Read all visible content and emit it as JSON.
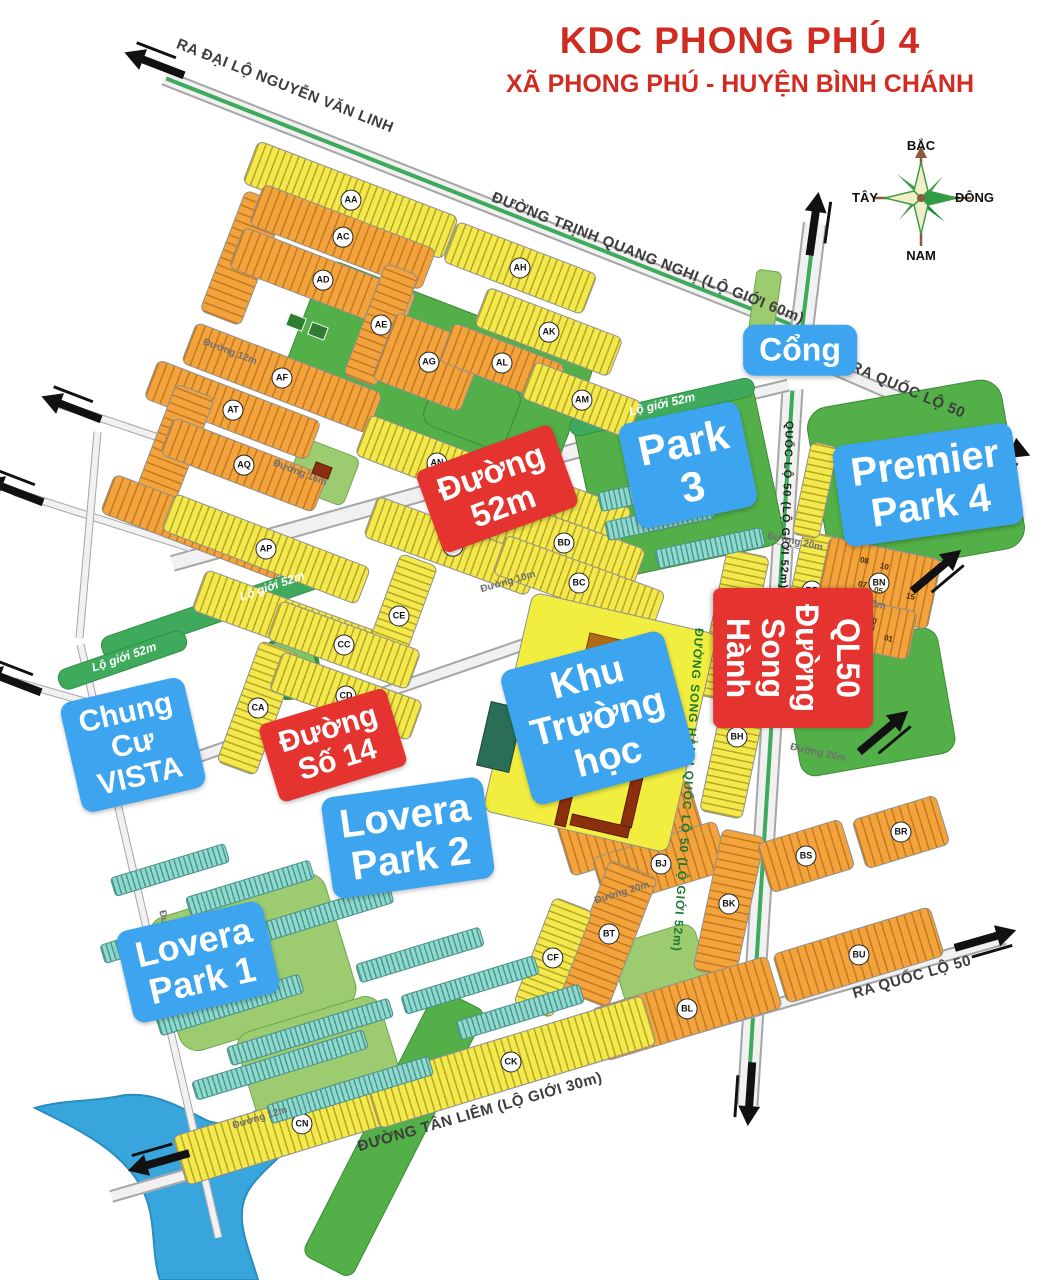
{
  "title": {
    "line1": "KDC PHONG PHÚ 4",
    "line2": "XÃ PHONG PHÚ - HUYỆN BÌNH CHÁNH"
  },
  "compass": {
    "north": "BẮC",
    "south": "NAM",
    "west": "TÂY",
    "east": "ĐÔNG"
  },
  "colors": {
    "title_red": "#d02c22",
    "overlay_blue": "#3da4f0",
    "overlay_red": "#e53430",
    "block_orange": "#f2a33c",
    "block_yellow": "#f3e84c",
    "teal": "#8fd9ce",
    "park_green": "#53af47",
    "river_blue": "#39a5dd",
    "median_green": "#3faa5c"
  },
  "overlay_labels": [
    {
      "name": "label-cong",
      "color": "blue",
      "lines": [
        "Cổng"
      ],
      "x": 800,
      "y": 350,
      "r": 0,
      "size": 32
    },
    {
      "name": "label-park-3",
      "color": "blue",
      "lines": [
        "Park 3"
      ],
      "x": 688,
      "y": 465,
      "r": -12,
      "size": 42
    },
    {
      "name": "label-premier-park-4",
      "color": "blue",
      "lines": [
        "Premier",
        "Park 4"
      ],
      "x": 928,
      "y": 485,
      "r": -8,
      "size": 40
    },
    {
      "name": "label-chung-cu-vista",
      "color": "blue",
      "lines": [
        "Chung Cư",
        "VISTA"
      ],
      "x": 133,
      "y": 745,
      "r": -13,
      "size": 30
    },
    {
      "name": "label-khu-truong-hoc",
      "color": "blue",
      "lines": [
        "Khu",
        "Trường học"
      ],
      "x": 598,
      "y": 718,
      "r": -15,
      "size": 38
    },
    {
      "name": "label-lovera-park-2",
      "color": "blue",
      "lines": [
        "Lovera",
        "Park 2"
      ],
      "x": 408,
      "y": 838,
      "r": -8,
      "size": 40
    },
    {
      "name": "label-lovera-park-1",
      "color": "blue",
      "lines": [
        "Lovera Park 1"
      ],
      "x": 198,
      "y": 962,
      "r": -13,
      "size": 36
    },
    {
      "name": "label-duong-52m",
      "color": "red",
      "lines": [
        "Đường 52m"
      ],
      "x": 497,
      "y": 489,
      "r": -20,
      "size": 33
    },
    {
      "name": "label-duong-so-14",
      "color": "red",
      "lines": [
        "Đường Số 14"
      ],
      "x": 333,
      "y": 745,
      "r": -17,
      "size": 30
    },
    {
      "name": "label-duong-song-hanh-ql50",
      "color": "red",
      "vertical": true,
      "lines": [
        "Đường Song Hành",
        "QL50"
      ],
      "x": 793,
      "y": 658,
      "r": 90,
      "size": 32
    }
  ],
  "road_names": [
    {
      "cls": "big",
      "text": "RA ĐẠI LỘ NGUYỄN VĂN LINH",
      "x": 285,
      "y": 86,
      "r": 21.5
    },
    {
      "cls": "big",
      "text": "ĐƯỜNG TRỊNH QUANG NGHỊ (LỘ GIỚI 60m)",
      "x": 648,
      "y": 258,
      "r": 21.5
    },
    {
      "cls": "big",
      "text": "RA QUỐC LỘ 50",
      "x": 908,
      "y": 390,
      "r": 23
    },
    {
      "cls": "big",
      "text": "RA QUỐC LỘ 50",
      "x": 912,
      "y": 977,
      "r": -16
    },
    {
      "cls": "big",
      "text": "ĐƯỜNG TÂN LIÊM (LỘ GIỚI 30m)",
      "x": 480,
      "y": 1112,
      "r": -16
    },
    {
      "cls": "blk",
      "text": "QUỐC LỘ 50 (LỘ GIỚI 52m)",
      "x": 786,
      "y": 505,
      "r": 92
    },
    {
      "cls": "grn",
      "text": "ĐƯỜNG SONG HÀNH QUỐC LỘ 50 (LỘ GIỚI 52m)",
      "x": 688,
      "y": 790,
      "r": 94
    },
    {
      "cls": "med",
      "text": "Lộ giới 52m",
      "x": 272,
      "y": 586,
      "r": -19
    },
    {
      "cls": "med",
      "text": "Lộ giới 52m",
      "x": 124,
      "y": 657,
      "r": -19
    },
    {
      "cls": "med",
      "text": "Lộ giới 52m",
      "x": 662,
      "y": 404,
      "r": -13
    },
    {
      "cls": "min",
      "text": "Đường 20m",
      "x": 795,
      "y": 542,
      "r": 12.5
    },
    {
      "cls": "min",
      "text": "Đường 13m",
      "x": 858,
      "y": 601,
      "r": 12
    },
    {
      "cls": "min",
      "text": "Đường 12m",
      "x": 846,
      "y": 663,
      "r": 12
    },
    {
      "cls": "min",
      "text": "Đường 20m",
      "x": 818,
      "y": 753,
      "r": 12
    },
    {
      "cls": "min",
      "text": "Đường 16m",
      "x": 300,
      "y": 473,
      "r": 21
    },
    {
      "cls": "min",
      "text": "Đường 12m",
      "x": 230,
      "y": 352,
      "r": 21
    },
    {
      "cls": "min",
      "text": "Đường 10m",
      "x": 508,
      "y": 582,
      "r": -16
    },
    {
      "cls": "min",
      "text": "Đường 20m",
      "x": 622,
      "y": 893,
      "r": -17
    },
    {
      "cls": "min",
      "text": "Đường 12m",
      "x": 260,
      "y": 1118,
      "r": -17
    },
    {
      "cls": "min",
      "text": "Đường 16m",
      "x": 168,
      "y": 938,
      "r": 77
    }
  ],
  "roads": [
    {
      "x": 490,
      "y": 206,
      "len": 700,
      "w": 16,
      "r": 21.5,
      "median": true
    },
    {
      "x": 807,
      "y": 288,
      "len": 130,
      "w": 24,
      "r": -83,
      "median": true
    },
    {
      "x": 918,
      "y": 405,
      "len": 196,
      "w": 13,
      "r": 23.4,
      "median": false
    },
    {
      "x": 770,
      "y": 747,
      "len": 718,
      "w": 22,
      "r": 93.6,
      "median": true
    },
    {
      "x": 558,
      "y": 1067,
      "len": 930,
      "w": 13,
      "r": -16.1,
      "median": false
    },
    {
      "x": 415,
      "y": 495,
      "len": 505,
      "w": 17,
      "r": -15.6,
      "median": false
    },
    {
      "x": 376,
      "y": 695,
      "len": 584,
      "w": 13,
      "r": -19,
      "median": false
    },
    {
      "x": 691,
      "y": 408,
      "len": 200,
      "w": 13,
      "r": -13.5,
      "median": false
    },
    {
      "x": 807,
      "y": 546,
      "len": 205,
      "w": 9,
      "r": 12.5,
      "median": false
    },
    {
      "x": 145,
      "y": 433,
      "len": 180,
      "w": 8,
      "r": 18.5,
      "median": false
    },
    {
      "x": 102,
      "y": 520,
      "len": 185,
      "w": 8,
      "r": 17.7,
      "median": false
    },
    {
      "x": 55,
      "y": 693,
      "len": 84,
      "w": 8,
      "r": 16,
      "median": false
    },
    {
      "x": 88,
      "y": 535,
      "len": 207,
      "w": 8,
      "r": 95,
      "median": false
    },
    {
      "x": 149,
      "y": 941,
      "len": 609,
      "w": 8,
      "r": 76.9,
      "median": false
    }
  ],
  "blocks": [
    {
      "id": "AA",
      "t": "y",
      "x": 350,
      "y": 200,
      "w": 215,
      "h": 46,
      "r": 21
    },
    {
      "id": "AB",
      "t": "o",
      "x": 243,
      "y": 258,
      "w": 44,
      "h": 130,
      "r": 21
    },
    {
      "id": "AC",
      "t": "o",
      "x": 342,
      "y": 237,
      "w": 185,
      "h": 44,
      "r": 21
    },
    {
      "id": "AD",
      "t": "o",
      "x": 322,
      "y": 280,
      "w": 185,
      "h": 44,
      "r": 21
    },
    {
      "id": "AE",
      "t": "o",
      "x": 381,
      "y": 325,
      "w": 36,
      "h": 120,
      "r": 21
    },
    {
      "id": "AF",
      "t": "o",
      "x": 282,
      "y": 378,
      "w": 200,
      "h": 44,
      "r": 21
    },
    {
      "id": "AG",
      "t": "o",
      "x": 428,
      "y": 362,
      "w": 95,
      "h": 72,
      "r": 21
    },
    {
      "id": "AH",
      "t": "y",
      "x": 520,
      "y": 268,
      "w": 150,
      "h": 44,
      "r": 21
    },
    {
      "id": "AK",
      "t": "y",
      "x": 548,
      "y": 332,
      "w": 145,
      "h": 42,
      "r": 21
    },
    {
      "id": "AL",
      "t": "o",
      "x": 502,
      "y": 363,
      "w": 120,
      "h": 42,
      "r": 21
    },
    {
      "id": "AM",
      "t": "y",
      "x": 581,
      "y": 400,
      "w": 115,
      "h": 40,
      "r": 21
    },
    {
      "id": "AT",
      "t": "o",
      "x": 232,
      "y": 410,
      "w": 175,
      "h": 42,
      "r": 21
    },
    {
      "id": "AS",
      "t": "o",
      "x": 176,
      "y": 442,
      "w": 42,
      "h": 110,
      "r": 21
    },
    {
      "id": "AQ",
      "t": "o",
      "x": 243,
      "y": 465,
      "w": 165,
      "h": 40,
      "r": 21
    },
    {
      "id": "AR",
      "t": "o",
      "x": 196,
      "y": 527,
      "w": 190,
      "h": 42,
      "r": 21
    },
    {
      "id": "AP",
      "t": "y",
      "x": 266,
      "y": 549,
      "w": 210,
      "h": 40,
      "r": 21
    },
    {
      "id": "AN",
      "t": "y",
      "x": 437,
      "y": 463,
      "w": 160,
      "h": 44,
      "r": 21
    },
    {
      "id": "BE",
      "t": "y",
      "x": 545,
      "y": 500,
      "w": 170,
      "h": 44,
      "r": 20
    },
    {
      "id": "BA",
      "t": "y",
      "x": 452,
      "y": 546,
      "w": 175,
      "h": 44,
      "r": 20
    },
    {
      "id": "BD",
      "t": "y",
      "x": 564,
      "y": 543,
      "w": 160,
      "h": 44,
      "r": 20
    },
    {
      "id": "BC",
      "t": "y",
      "x": 579,
      "y": 583,
      "w": 170,
      "h": 42,
      "r": 20
    },
    {
      "id": "CB",
      "t": "y",
      "x": 288,
      "y": 622,
      "w": 190,
      "h": 44,
      "r": 20
    },
    {
      "id": "CE",
      "t": "y",
      "x": 399,
      "y": 616,
      "w": 40,
      "h": 120,
      "r": 20
    },
    {
      "id": "CC",
      "t": "y",
      "x": 344,
      "y": 645,
      "w": 150,
      "h": 42,
      "r": 20
    },
    {
      "id": "CA",
      "t": "y",
      "x": 258,
      "y": 708,
      "w": 42,
      "h": 130,
      "r": 20
    },
    {
      "id": "CD",
      "t": "y",
      "x": 346,
      "y": 696,
      "w": 150,
      "h": 42,
      "r": 20
    },
    {
      "id": "BG",
      "t": "y",
      "x": 733,
      "y": 626,
      "w": 44,
      "h": 150,
      "r": 12
    },
    {
      "id": "BH",
      "t": "y",
      "x": 737,
      "y": 737,
      "w": 44,
      "h": 160,
      "r": 12
    },
    {
      "id": "BP",
      "t": "y",
      "x": 812,
      "y": 590,
      "w": 42,
      "h": 115,
      "r": 12
    },
    {
      "id": "BN",
      "t": "o",
      "x": 878,
      "y": 583,
      "w": 115,
      "h": 72,
      "r": 12
    },
    {
      "id": "BM",
      "t": "o",
      "x": 864,
      "y": 626,
      "w": 100,
      "h": 50,
      "r": 12
    },
    {
      "id": "BF",
      "t": "o",
      "x": 630,
      "y": 828,
      "w": 140,
      "h": 60,
      "r": -17
    },
    {
      "id": "BJ",
      "t": "o",
      "x": 661,
      "y": 864,
      "w": 130,
      "h": 52,
      "r": -17
    },
    {
      "id": "BK",
      "t": "o",
      "x": 729,
      "y": 903,
      "w": 44,
      "h": 145,
      "r": 12
    },
    {
      "id": "BT",
      "t": "o",
      "x": 609,
      "y": 934,
      "w": 52,
      "h": 140,
      "r": 21
    },
    {
      "id": "BL",
      "t": "o",
      "x": 686,
      "y": 1008,
      "w": 185,
      "h": 55,
      "r": -17
    },
    {
      "id": "BU",
      "t": "o",
      "x": 858,
      "y": 955,
      "w": 165,
      "h": 52,
      "r": -17
    },
    {
      "id": "BS",
      "t": "o",
      "x": 806,
      "y": 856,
      "w": 88,
      "h": 52,
      "r": -17
    },
    {
      "id": "BR",
      "t": "o",
      "x": 901,
      "y": 832,
      "w": 88,
      "h": 52,
      "r": -17
    },
    {
      "id": "CF",
      "t": "y",
      "x": 553,
      "y": 957,
      "w": 42,
      "h": 115,
      "r": 21
    },
    {
      "id": "CN",
      "t": "y",
      "x": 301,
      "y": 1124,
      "w": 255,
      "h": 52,
      "r": -17
    },
    {
      "id": "CK",
      "t": "y",
      "x": 511,
      "y": 1062,
      "w": 290,
      "h": 52,
      "r": -17
    },
    {
      "id": "",
      "t": "y",
      "x": 815,
      "y": 490,
      "w": 28,
      "h": 95,
      "r": 12
    },
    {
      "id": "",
      "t": "school",
      "x": 600,
      "y": 722,
      "w": 190,
      "h": 225,
      "r": 13
    }
  ],
  "teal_rows": [
    [
      170,
      870,
      120,
      -17
    ],
    [
      250,
      888,
      130,
      -17
    ],
    [
      150,
      940,
      100,
      -17
    ],
    [
      320,
      915,
      150,
      -17
    ],
    [
      230,
      1005,
      150,
      -17
    ],
    [
      310,
      1032,
      170,
      -17
    ],
    [
      280,
      1065,
      180,
      -17
    ],
    [
      350,
      1090,
      170,
      -17
    ],
    [
      420,
      955,
      130,
      -17
    ],
    [
      470,
      985,
      140,
      -17
    ],
    [
      520,
      1012,
      130,
      -17
    ],
    [
      660,
      520,
      110,
      -12
    ],
    [
      710,
      548,
      110,
      -12
    ],
    [
      648,
      492,
      100,
      -12
    ]
  ],
  "parks": [
    {
      "t": "green",
      "x": 435,
      "y": 378,
      "w": 290,
      "h": 148,
      "r": 21,
      "rad": 16
    },
    {
      "t": "court",
      "x": 296,
      "y": 322,
      "w": 18,
      "h": 14,
      "r": 21
    },
    {
      "t": "court",
      "x": 318,
      "y": 331,
      "w": 18,
      "h": 14,
      "r": 21
    },
    {
      "t": "light",
      "x": 323,
      "y": 472,
      "w": 62,
      "h": 52,
      "r": 21,
      "rad": 8
    },
    {
      "t": "green",
      "x": 472,
      "y": 407,
      "w": 88,
      "h": 66,
      "r": 21,
      "rad": 14
    },
    {
      "t": "ring",
      "x": 288,
      "y": 668,
      "w": 64,
      "h": 64,
      "r": 0
    },
    {
      "t": "green",
      "x": 678,
      "y": 480,
      "w": 185,
      "h": 168,
      "r": -12,
      "rad": 18
    },
    {
      "t": "green",
      "x": 916,
      "y": 478,
      "w": 198,
      "h": 172,
      "r": -10,
      "rad": 22
    },
    {
      "t": "light",
      "x": 765,
      "y": 303,
      "w": 26,
      "h": 66,
      "r": 8,
      "rad": 6
    },
    {
      "t": "green",
      "x": 869,
      "y": 702,
      "w": 158,
      "h": 128,
      "r": -10,
      "rad": 16
    },
    {
      "t": "light",
      "x": 666,
      "y": 985,
      "w": 88,
      "h": 108,
      "r": -17,
      "rad": 14
    },
    {
      "t": "light",
      "x": 252,
      "y": 962,
      "w": 185,
      "h": 140,
      "r": -17,
      "rad": 20
    },
    {
      "t": "light",
      "x": 318,
      "y": 1058,
      "w": 150,
      "h": 92,
      "r": -17,
      "rad": 16
    },
    {
      "t": "green",
      "x": 394,
      "y": 1133,
      "w": 56,
      "h": 300,
      "r": 27,
      "rad": 10
    },
    {
      "t": "median",
      "x": 225,
      "y": 608,
      "w": 260,
      "h": 24,
      "r": -19
    },
    {
      "t": "median",
      "x": 122,
      "y": 660,
      "w": 135,
      "h": 22,
      "r": -19
    },
    {
      "t": "median",
      "x": 662,
      "y": 407,
      "w": 190,
      "h": 20,
      "r": -13
    },
    {
      "t": "light",
      "x": 563,
      "y": 662,
      "w": 40,
      "h": 36,
      "r": 13,
      "rad": 6
    },
    {
      "t": "light",
      "x": 650,
      "y": 700,
      "w": 44,
      "h": 40,
      "r": 13,
      "rad": 6
    },
    {
      "t": "light",
      "x": 572,
      "y": 800,
      "w": 40,
      "h": 44,
      "r": 13,
      "rad": 6
    }
  ],
  "buildings": [
    {
      "x": 612,
      "y": 655,
      "w": 54,
      "h": 34,
      "r": 13,
      "c": "#b06a12"
    },
    {
      "x": 600,
      "y": 768,
      "w": 86,
      "h": 12,
      "r": 13,
      "c": "#8b2f0e"
    },
    {
      "x": 567,
      "y": 795,
      "w": 12,
      "h": 64,
      "r": 13,
      "c": "#8b2f0e"
    },
    {
      "x": 633,
      "y": 796,
      "w": 12,
      "h": 64,
      "r": 13,
      "c": "#8b2f0e"
    },
    {
      "x": 600,
      "y": 826,
      "w": 60,
      "h": 12,
      "r": 13,
      "c": "#8b2f0e"
    },
    {
      "x": 322,
      "y": 470,
      "w": 18,
      "h": 13,
      "r": 21,
      "c": "#8b2f0e"
    },
    {
      "x": 500,
      "y": 737,
      "w": 34,
      "h": 66,
      "r": 13,
      "c": "#2b6e57"
    }
  ],
  "lot_numbers": [
    {
      "t": "08",
      "x": 860,
      "y": 556
    },
    {
      "t": "10",
      "x": 880,
      "y": 562
    },
    {
      "t": "07",
      "x": 858,
      "y": 580
    },
    {
      "t": "05",
      "x": 874,
      "y": 586
    },
    {
      "t": "15",
      "x": 906,
      "y": 592
    },
    {
      "t": "05",
      "x": 846,
      "y": 620
    },
    {
      "t": "10",
      "x": 868,
      "y": 616
    },
    {
      "t": "03",
      "x": 856,
      "y": 640
    },
    {
      "t": "01",
      "x": 884,
      "y": 634
    }
  ],
  "arrows": [
    {
      "x": 155,
      "y": 62,
      "r": -69
    },
    {
      "x": 816,
      "y": 224,
      "r": 8
    },
    {
      "x": 1000,
      "y": 445,
      "r": 113
    },
    {
      "x": 938,
      "y": 572,
      "r": 50
    },
    {
      "x": 885,
      "y": 733,
      "r": 50
    },
    {
      "x": 986,
      "y": 941,
      "r": 74
    },
    {
      "x": 748,
      "y": 1094,
      "r": 184
    },
    {
      "x": 158,
      "y": 1160,
      "r": 254
    },
    {
      "x": 72,
      "y": 406,
      "r": -69
    },
    {
      "x": 14,
      "y": 489,
      "r": -69
    },
    {
      "x": 12,
      "y": 679,
      "r": -69
    }
  ]
}
